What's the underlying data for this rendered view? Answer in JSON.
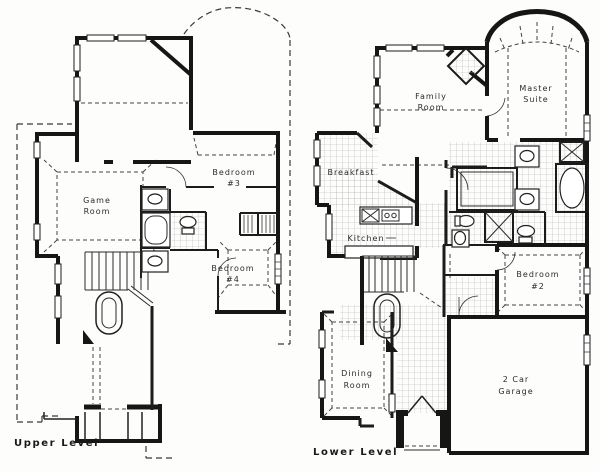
{
  "colors": {
    "ink": "#1a1a1a",
    "paper": "#fdfdfb",
    "tile_line": "#b3b3b3",
    "dash_line": "#3a3a3a"
  },
  "plans": [
    {
      "name": "Upper Level",
      "rooms": {
        "game_room": {
          "line1": "Game",
          "line2": "Room"
        },
        "bedroom3": {
          "line1": "Bedroom",
          "line2": "#3"
        },
        "bedroom4": {
          "line1": "Bedroom",
          "line2": "#4"
        }
      }
    },
    {
      "name": "Lower Level",
      "rooms": {
        "family_room": {
          "line1": "Family",
          "line2": "Room"
        },
        "master_suite": {
          "line1": "Master",
          "line2": "Suite"
        },
        "breakfast": {
          "line1": "Breakfast"
        },
        "kitchen": {
          "line1": "Kitchen"
        },
        "bedroom2": {
          "line1": "Bedroom",
          "line2": "#2"
        },
        "dining_room": {
          "line1": "Dining",
          "line2": "Room"
        },
        "garage": {
          "line1": "2 Car",
          "line2": "Garage"
        }
      }
    }
  ]
}
